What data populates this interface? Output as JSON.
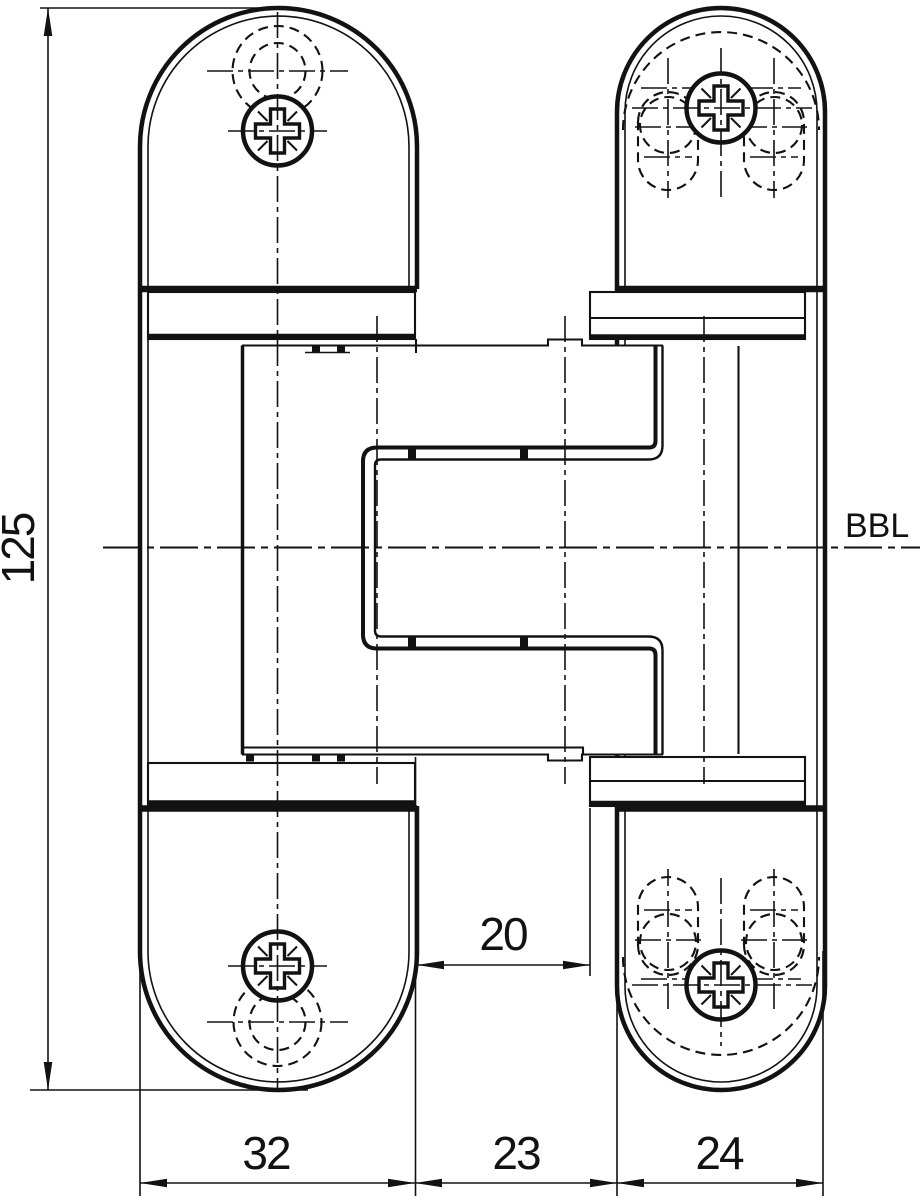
{
  "dimensions": {
    "height": "125",
    "offset": "20",
    "widths": [
      "32",
      "23",
      "24"
    ]
  },
  "reference_line": {
    "label": "BBL"
  },
  "theme": {
    "ink": "#121212",
    "paper": "#ffffff"
  }
}
